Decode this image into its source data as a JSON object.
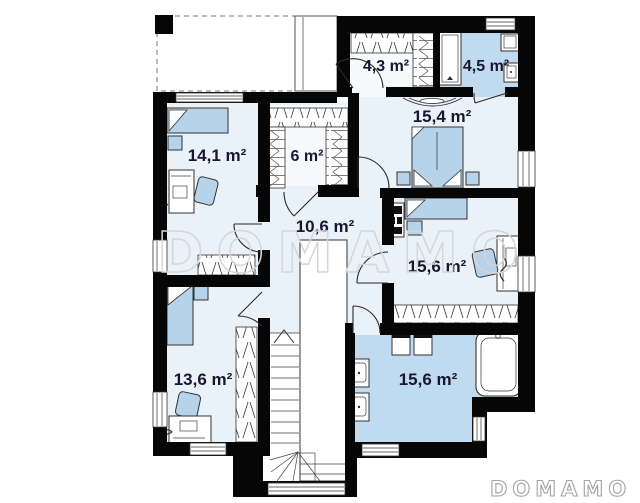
{
  "plan": {
    "watermark_large": "DOMAMO",
    "watermark_small": "DOMAMO",
    "colors": {
      "wall": "#060606",
      "room_floor": "#e9f1f9",
      "closet_floor": "#f7fafd",
      "bathroom_floor": "#c0daf0",
      "furniture": "#b7d3ea",
      "label_text": "#17172f",
      "watermark": "#d6d6d6"
    },
    "rooms": [
      {
        "id": "bedroom-14-1",
        "label": "14,1 m²"
      },
      {
        "id": "closet-6",
        "label": "6 m²"
      },
      {
        "id": "closet-4-3",
        "label": "4,3 m²"
      },
      {
        "id": "bathroom-4-5",
        "label": "4,5 m²"
      },
      {
        "id": "bedroom-15-4",
        "label": "15,4 m²"
      },
      {
        "id": "hall-10-6",
        "label": "10,6 m²"
      },
      {
        "id": "bedroom-15-6",
        "label": "15,6 m²"
      },
      {
        "id": "bedroom-13-6",
        "label": "13,6 m²"
      },
      {
        "id": "bathroom-15-6",
        "label": "15,6 m²"
      }
    ]
  }
}
